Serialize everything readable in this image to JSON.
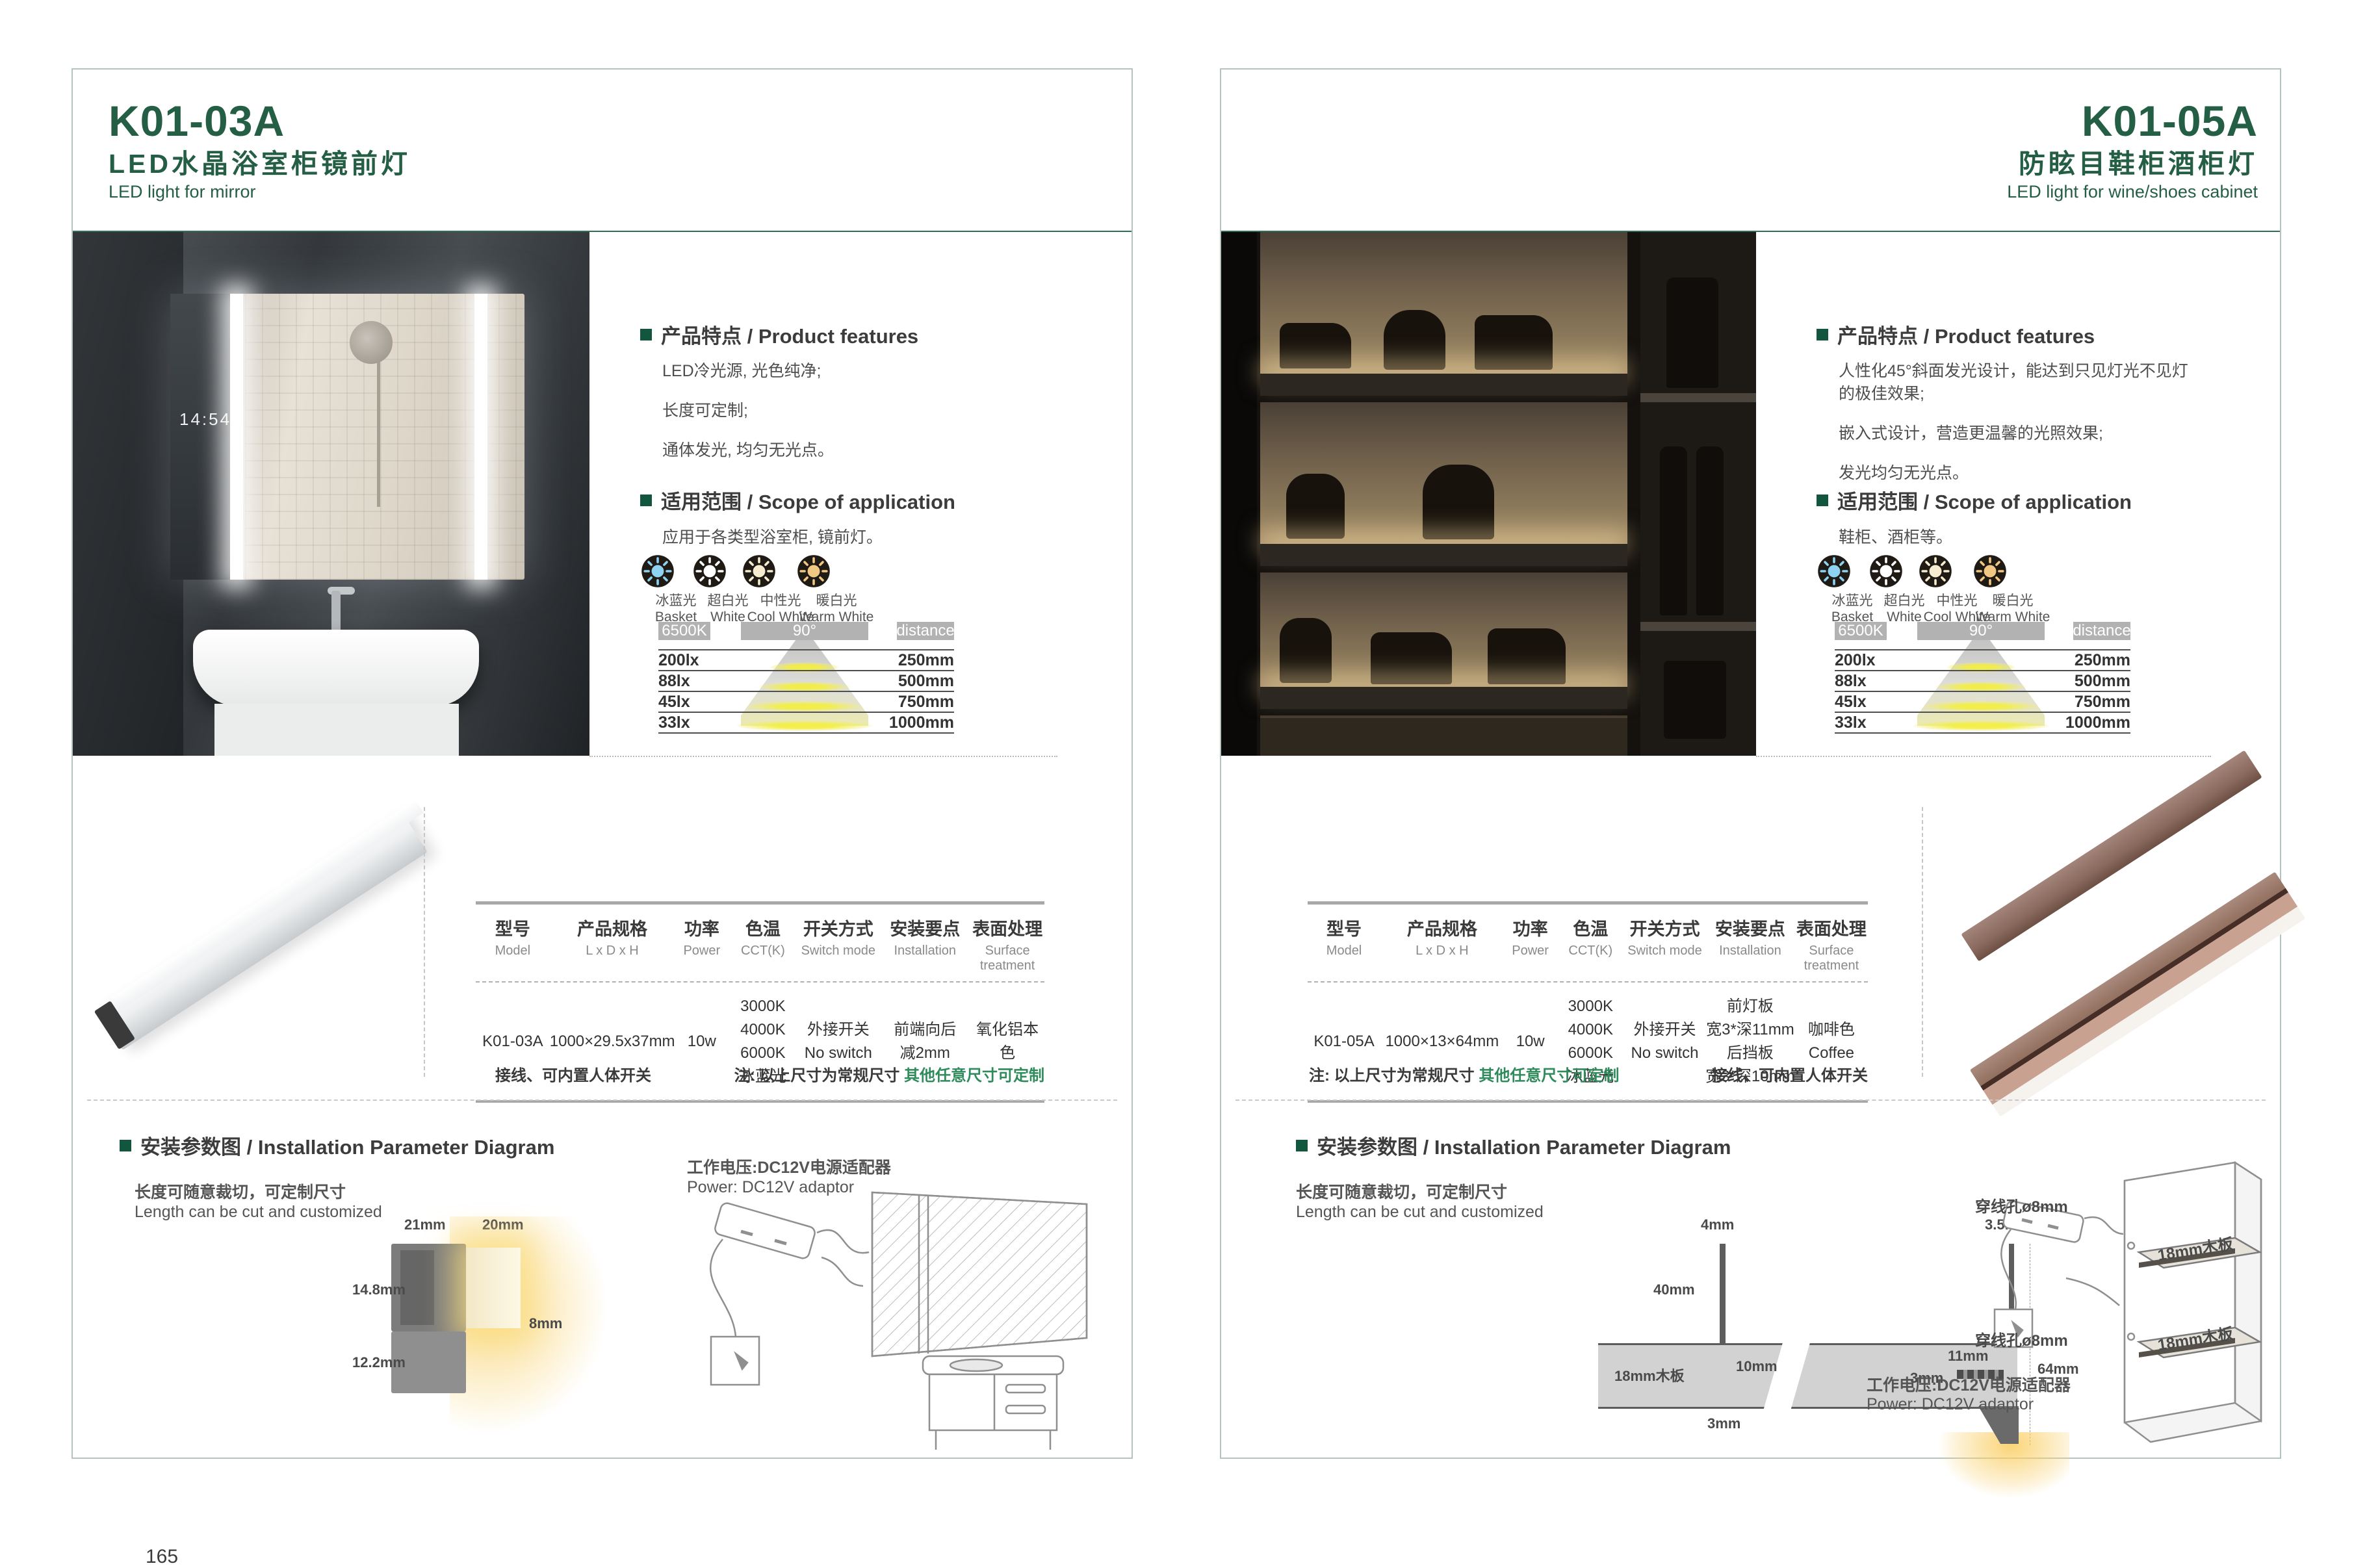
{
  "shared": {
    "headings": {
      "features": "产品特点 / Product features",
      "scope": "适用范围 / Scope of application",
      "install": "安装参数图 / Installation Parameter Diagram"
    },
    "cut_note_cn": "长度可随意裁切，可定制尺寸",
    "cut_note_en": "Length can be cut and customized",
    "power_note_cn": "工作电压:DC12V电源适配器",
    "power_note_en": "Power: DC12V adaptor",
    "wire_note": "接线、可内置人体开关",
    "size_note_prefix": "注: 以上尺寸为常规尺寸 ",
    "size_note_custom": "其他任意尺寸可定制",
    "colors": {
      "brand_green": "#245e45",
      "note_green": "#2f8b5c",
      "bar_gray": "#b2b2b2"
    },
    "light_icons": [
      {
        "cn": "冰蓝光",
        "en": "Basket",
        "style": "color:#8ed3f2"
      },
      {
        "cn": "超白光",
        "en": "White",
        "style": "color:#ffffff"
      },
      {
        "cn": "中性光",
        "en": "Cool White",
        "style": "color:#f6ecd0"
      },
      {
        "cn": "暖白光",
        "en": "Warm White",
        "style": "color:#f0c883"
      }
    ],
    "photometry": {
      "cct": "6500K",
      "angle": "90°",
      "distance_label": "distance",
      "rows": [
        {
          "lux": "200lx",
          "distance": "250mm"
        },
        {
          "lux": "88lx",
          "distance": "500mm"
        },
        {
          "lux": "45lx",
          "distance": "750mm"
        },
        {
          "lux": "33lx",
          "distance": "1000mm"
        }
      ]
    },
    "table_headers": [
      {
        "cn": "型号",
        "en": "Model"
      },
      {
        "cn": "产品规格",
        "en": "L x D x H"
      },
      {
        "cn": "功率",
        "en": "Power"
      },
      {
        "cn": "色温",
        "en": "CCT(K)"
      },
      {
        "cn": "开关方式",
        "en": "Switch mode"
      },
      {
        "cn": "安装要点",
        "en": "Installation"
      },
      {
        "cn": "表面处理",
        "en": "Surface treatment"
      }
    ]
  },
  "left": {
    "code": "K01-03A",
    "title_cn": "LED水晶浴室柜镜前灯",
    "title_en": "LED light for mirror",
    "page_number": "165",
    "photo_clock": "14:54",
    "features": [
      "LED冷光源, 光色纯净;",
      "长度可定制;",
      "通体发光, 均匀无光点。"
    ],
    "scope": "应用于各类型浴室柜, 镜前灯。",
    "spec": {
      "model": "K01-03A",
      "size": "1000×29.5x37mm",
      "power": "10w",
      "cct": [
        "3000K",
        "4000K",
        "6000K",
        "冰蓝光"
      ],
      "switch": [
        "外接开关",
        "No switch"
      ],
      "install": [
        "前端向后",
        "减2mm"
      ],
      "surface": [
        "氧化铝本色"
      ]
    },
    "dims": {
      "top_width": "21mm",
      "light_width": "20mm",
      "body_height": "14.8mm",
      "light_height": "8mm",
      "bracket_height": "12.2mm"
    }
  },
  "right": {
    "code": "K01-05A",
    "title_cn": "防眩目鞋柜酒柜灯",
    "title_en": "LED light for wine/shoes cabinet",
    "page_number": "166",
    "features": [
      "人性化45°斜面发光设计，能达到只见灯光不见灯的极佳效果;",
      "嵌入式设计，营造更温馨的光照效果;",
      "发光均匀无光点。"
    ],
    "scope": "鞋柜、酒柜等。",
    "spec": {
      "model": "K01-05A",
      "size": "1000×13×64mm",
      "power": "10w",
      "cct": [
        "3000K",
        "4000K",
        "6000K",
        "冰蓝光"
      ],
      "switch": [
        "外接开关",
        "No switch"
      ],
      "install": [
        "前灯板",
        "宽3*深11mm",
        "后挡板",
        "宽3*深10mm"
      ],
      "surface": [
        "咖啡色",
        "Coffee"
      ]
    },
    "dims": {
      "panel_thickness": "4mm",
      "lip_thickness": "3.5mm",
      "panel_height": "40mm",
      "board": "18mm木板",
      "slot_depth": "10mm",
      "slot_width": "3mm",
      "front_depth": "11mm",
      "back_depth": "3mm",
      "total_height": "64mm"
    },
    "cabinet": {
      "hole_top": "穿线孔ø8mm",
      "hole_bottom": "穿线孔ø8mm",
      "shelf_top": "18mm木板",
      "shelf_bottom": "18mm木板"
    }
  }
}
